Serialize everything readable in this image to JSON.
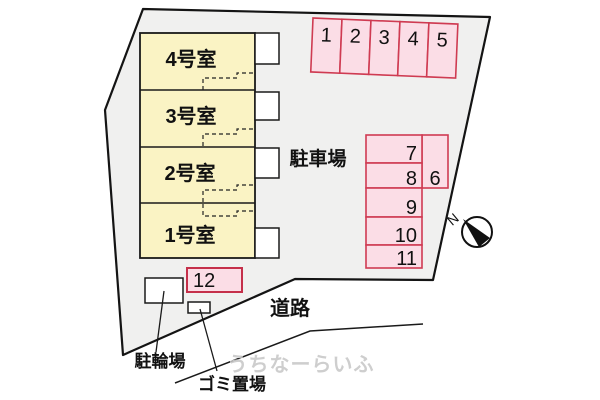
{
  "site_plan": {
    "rooms": [
      {
        "label": "4号室"
      },
      {
        "label": "3号室"
      },
      {
        "label": "2号室"
      },
      {
        "label": "1号室"
      }
    ],
    "parking": {
      "area_label": "駐車場",
      "top_row_spaces": [
        "1",
        "2",
        "3",
        "4",
        "5"
      ],
      "right_column_spaces": [
        "7",
        "8",
        "9",
        "10",
        "11"
      ],
      "wide_space": "6",
      "south_space": "12"
    },
    "labels": {
      "road": "道路",
      "bicycle_parking": "駐輪場",
      "garbage_area": "ゴミ置場",
      "north": "N"
    },
    "watermark": "うちなーらいふ",
    "colors": {
      "room_fill": "#faf3c4",
      "parking_fill": "#fbdde6",
      "parking_border": "#cf3b52",
      "plot_fill": "#f0f0ef",
      "line": "#1a1a1a"
    }
  }
}
